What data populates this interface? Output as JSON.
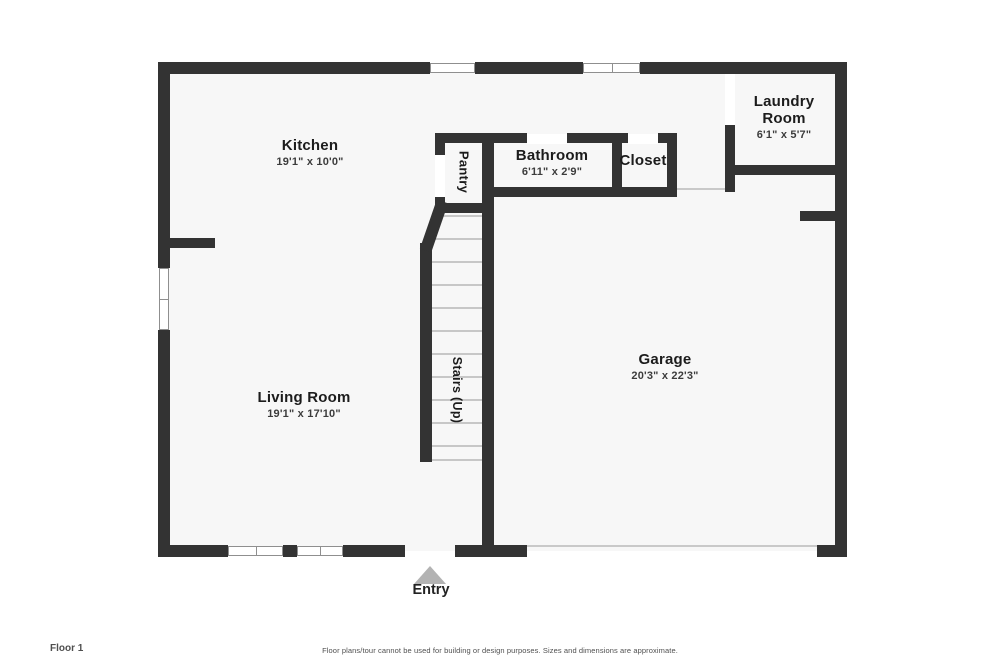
{
  "plan": {
    "floor_label": "Floor 1",
    "disclaimer": "Floor plans/tour cannot be used for building or design purposes. Sizes and dimensions are approximate.",
    "entry_label": "Entry"
  },
  "rooms": [
    {
      "id": "kitchen",
      "name": "Kitchen",
      "dims": "19'1\" x 10'0\""
    },
    {
      "id": "pantry",
      "name": "Pantry"
    },
    {
      "id": "bathroom",
      "name": "Bathroom",
      "dims": "6'11\" x 2'9\""
    },
    {
      "id": "closet",
      "name": "Closet"
    },
    {
      "id": "laundry",
      "name": "Laundry Room",
      "dims": "6'1\" x 5'7\""
    },
    {
      "id": "garage",
      "name": "Garage",
      "dims": "20'3\" x 22'3\""
    },
    {
      "id": "living",
      "name": "Living Room",
      "dims": "19'1\" x 17'10\""
    },
    {
      "id": "stairs",
      "name": "Stairs (Up)"
    }
  ],
  "colors": {
    "wall": "#333333",
    "interior_fill": "#f7f7f7",
    "window_frame": "#8f8f8f",
    "entry_arrow": "#b3b3b3"
  }
}
